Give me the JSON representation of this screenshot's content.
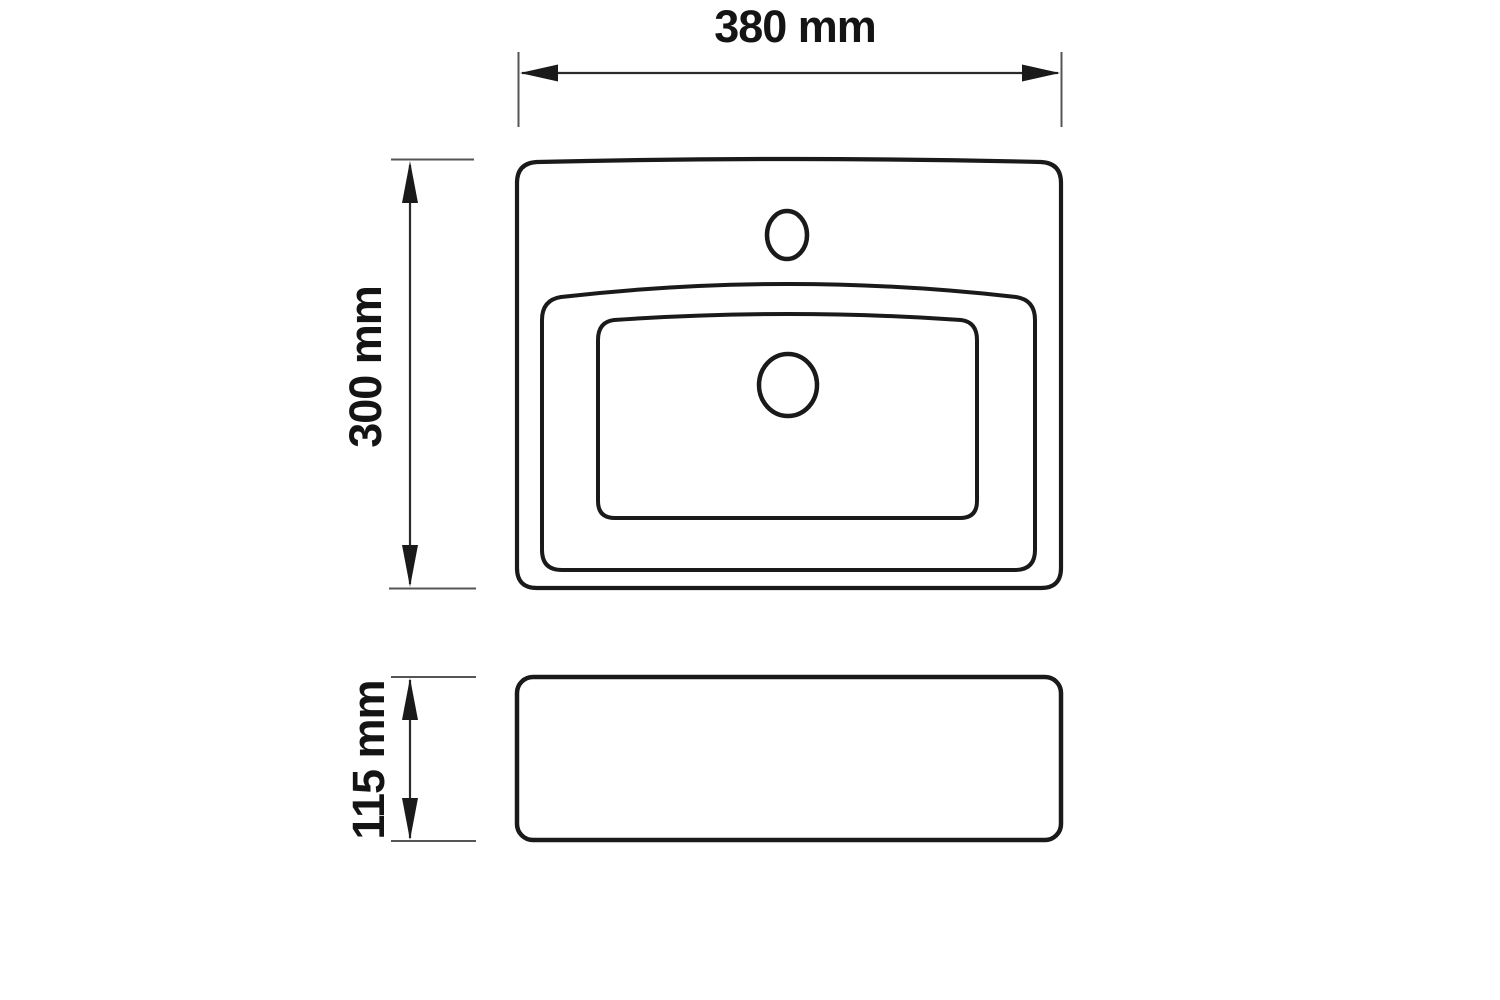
{
  "page": {
    "background_color": "#ffffff",
    "line_color": "#1a1a1a",
    "dimension_line_color": "#2b2b2b",
    "extension_tick_color": "#555555"
  },
  "drawing": {
    "type": "technical-dimension-drawing",
    "subject": "rectangular washbasin",
    "views": [
      {
        "name": "top-view",
        "features": [
          "outer-rim",
          "basin-rim",
          "basin-floor",
          "faucet-hole",
          "drain-hole"
        ]
      },
      {
        "name": "front-view",
        "features": [
          "body-outline"
        ]
      }
    ]
  },
  "dimensions": {
    "width": {
      "label": "380 mm",
      "value": 380,
      "unit": "mm",
      "orientation": "horizontal"
    },
    "depth": {
      "label": "300 mm",
      "value": 300,
      "unit": "mm",
      "orientation": "vertical"
    },
    "height": {
      "label": "115 mm",
      "value": 115,
      "unit": "mm",
      "orientation": "vertical"
    }
  }
}
